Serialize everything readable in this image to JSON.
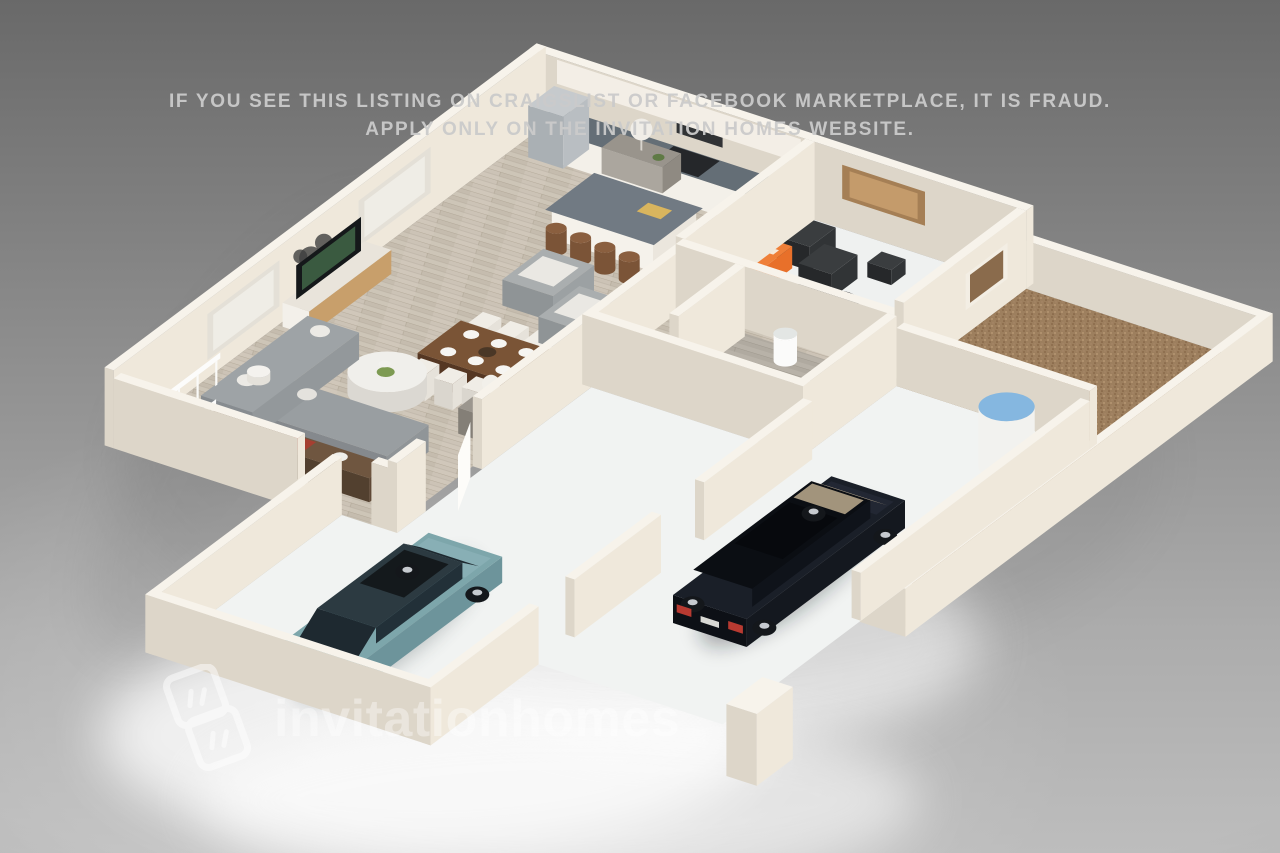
{
  "warning": {
    "line1": "IF YOU SEE THIS LISTING ON CRAIGSLIST OR FACEBOOK MARKETPLACE, IT IS FRAUD.",
    "line2": "APPLY ONLY ON THE INVITATION HOMES WEBSITE."
  },
  "watermark": {
    "text": "invitationhomes",
    "logo_icon": "invitation-homes-logo"
  },
  "scene": {
    "type": "isometric-3d-floor-plan",
    "rooms": [
      "kitchen",
      "dining area",
      "living room",
      "covered patio",
      "powder room",
      "garage",
      "driveway",
      "backyard",
      "stairs"
    ],
    "objects": [
      "stainless refrigerator",
      "black range with hood",
      "kitchen island with barstools",
      "sink",
      "dining table with 6 white chairs",
      "tv media console",
      "gray sectional sofa",
      "two gray armchairs",
      "round white coffee table",
      "sofa-back console",
      "table lamps",
      "wall art",
      "two black patio chairs with ottoman",
      "two orange patio sofas",
      "round black patio table",
      "toilet",
      "pedestal sink",
      "water heater",
      "teal sedan",
      "black suv",
      "white pillar"
    ],
    "colors": {
      "bg_top": "#696969",
      "bg_bottom": "#bdbdbd",
      "wall_top": "#f7f3eb",
      "wall_shade": "#ddd6c9",
      "wall_light": "#efe8db",
      "wood_floor": "#cdc5b7",
      "powder_floor": "#b8b2a8",
      "yard": "#9d7f5e",
      "concrete": "#eff1f0",
      "counter": "#646e76",
      "island_top": "#717a83",
      "accent_orange": "#e8702a",
      "sofa_gray": "#999ea1",
      "table_wood": "#7a5436",
      "console_wood": "#6f5640",
      "teal_car": "#7da6ab",
      "black_suv": "#14181f",
      "heater_blue": "#85b7e0",
      "stool_wood": "#8a5f3f",
      "taillight_red": "#c8463a",
      "watermark_white": "#ffffff",
      "warning_text": "#cbcbcb"
    }
  }
}
